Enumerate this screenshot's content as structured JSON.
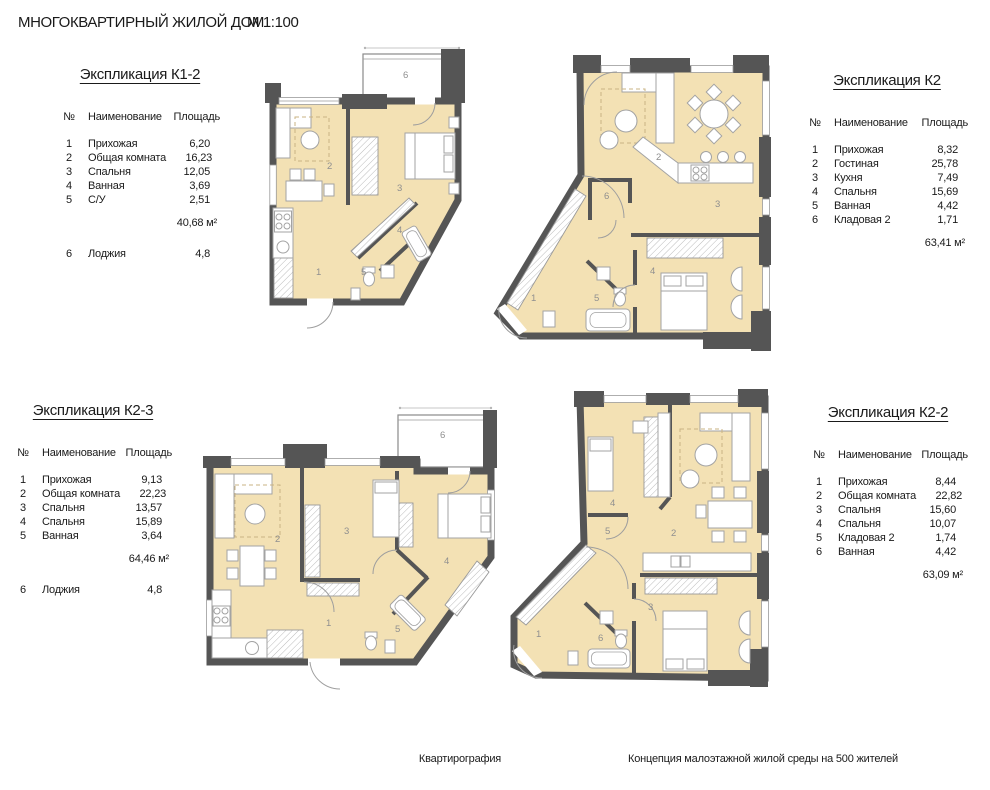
{
  "page": {
    "title": "МНОГОКВАРТИРНЫЙ ЖИЛОЙ ДОМ",
    "scale": "М 1:100",
    "footer_left": "Квартирография",
    "footer_right": "Концепция малоэтажной жилой среды на 500 жителей"
  },
  "colors": {
    "wall": "#555555",
    "floor": "#f3e1b4",
    "room_label": "#8f8f8f",
    "accent_rug": "#c9b383"
  },
  "tables": [
    {
      "title": "Экспликация К1-2",
      "col_num": "№",
      "col_name": "Наименование",
      "col_area": "Площадь",
      "rows": [
        {
          "num": "1",
          "name": "Прихожая",
          "area": "6,20"
        },
        {
          "num": "2",
          "name": "Общая комната",
          "area": "16,23"
        },
        {
          "num": "3",
          "name": "Спальня",
          "area": "12,05"
        },
        {
          "num": "4",
          "name": "Ванная",
          "area": "3,69"
        },
        {
          "num": "5",
          "name": "С/У",
          "area": "2,51"
        }
      ],
      "total": "40,68 м²",
      "loggia": {
        "num": "6",
        "name": "Лоджия",
        "area": "4,8"
      }
    },
    {
      "title": "Экспликация К2",
      "col_num": "№",
      "col_name": "Наименование",
      "col_area": "Площадь",
      "rows": [
        {
          "num": "1",
          "name": "Прихожая",
          "area": "8,32"
        },
        {
          "num": "2",
          "name": "Гостиная",
          "area": "25,78"
        },
        {
          "num": "3",
          "name": "Кухня",
          "area": "7,49"
        },
        {
          "num": "4",
          "name": "Спальня",
          "area": "15,69"
        },
        {
          "num": "5",
          "name": "Ванная",
          "area": "4,42"
        },
        {
          "num": "6",
          "name": "Кладовая 2",
          "area": "1,71"
        }
      ],
      "total": "63,41 м²"
    },
    {
      "title": "Экспликация К2-3",
      "col_num": "№",
      "col_name": "Наименование",
      "col_area": "Площадь",
      "rows": [
        {
          "num": "1",
          "name": "Прихожая",
          "area": "9,13"
        },
        {
          "num": "2",
          "name": "Общая комната",
          "area": "22,23"
        },
        {
          "num": "3",
          "name": "Спальня",
          "area": "13,57"
        },
        {
          "num": "4",
          "name": "Спальня",
          "area": "15,89"
        },
        {
          "num": "5",
          "name": "Ванная",
          "area": "3,64"
        }
      ],
      "total": "64,46 м²",
      "loggia": {
        "num": "6",
        "name": "Лоджия",
        "area": "4,8"
      }
    },
    {
      "title": "Экспликация К2-2",
      "col_num": "№",
      "col_name": "Наименование",
      "col_area": "Площадь",
      "rows": [
        {
          "num": "1",
          "name": "Прихожая",
          "area": "8,44"
        },
        {
          "num": "2",
          "name": "Общая комната",
          "area": "22,82"
        },
        {
          "num": "3",
          "name": "Спальня",
          "area": "15,60"
        },
        {
          "num": "4",
          "name": "Спальня",
          "area": "10,07"
        },
        {
          "num": "5",
          "name": "Кладовая 2",
          "area": "1,74"
        },
        {
          "num": "6",
          "name": "Ванная",
          "area": "4,42"
        }
      ],
      "total": "63,09 м²"
    }
  ],
  "plans": [
    {
      "name": "К1-2",
      "room_labels": [
        "1",
        "2",
        "3",
        "4",
        "5",
        "6"
      ]
    },
    {
      "name": "К2",
      "room_labels": [
        "1",
        "2",
        "3",
        "4",
        "5",
        "6"
      ]
    },
    {
      "name": "К2-3",
      "room_labels": [
        "1",
        "2",
        "3",
        "4",
        "5",
        "6"
      ]
    },
    {
      "name": "К2-2",
      "room_labels": [
        "1",
        "2",
        "3",
        "4",
        "5",
        "6"
      ]
    }
  ]
}
